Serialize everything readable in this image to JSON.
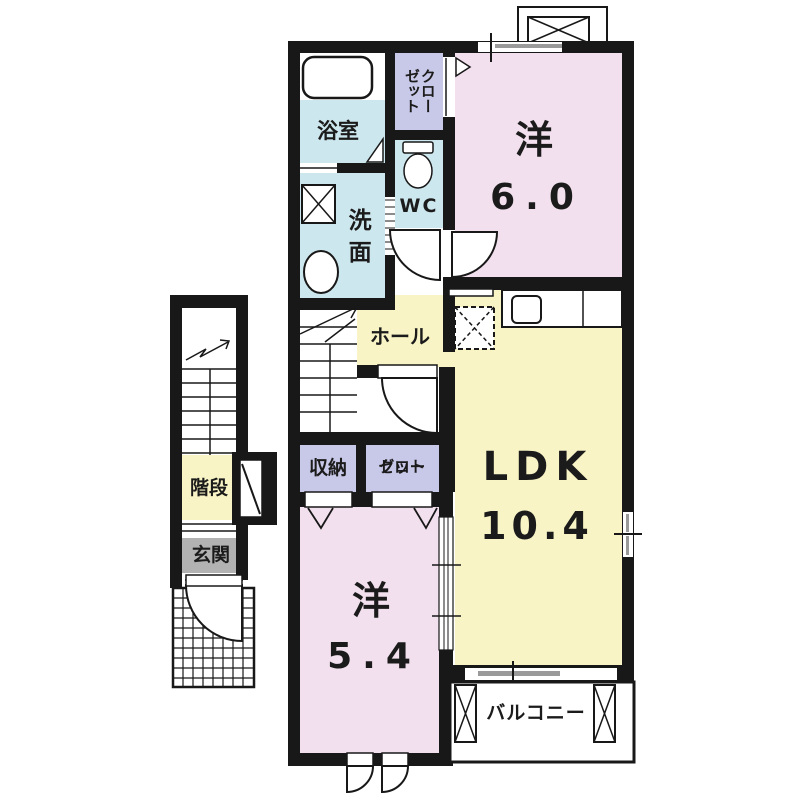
{
  "document": {
    "type": "apartment-floor-plan"
  },
  "colors": {
    "wall": "#181818",
    "room_pink": "#f3e0ee",
    "room_yellow": "#f8f4c5",
    "wet_blue": "#cde7ee",
    "closet_lavender": "#c8c8e8",
    "entrance_gray": "#b2b2b2",
    "window_gray": "#9a9a9a",
    "text": "#1b1b1b"
  },
  "rooms": {
    "bath": {
      "label": "浴室"
    },
    "washroom": {
      "label": "洗面"
    },
    "wc": {
      "label": "WC"
    },
    "closet_upper": {
      "line1": "クロー",
      "line2": "ゼット"
    },
    "bedroom_east": {
      "label": "洋",
      "size": "6.0"
    },
    "hall": {
      "label": "ホール"
    },
    "ldk": {
      "label": "LDK",
      "size": "10.4"
    },
    "storage": {
      "label": "収納"
    },
    "closet_lower": {
      "line1": "クロー",
      "line2": "ゼット"
    },
    "bedroom_south": {
      "label": "洋",
      "size": "5.4"
    },
    "balcony": {
      "label": "バルコニー"
    },
    "staircase": {
      "label": "階段"
    },
    "entrance": {
      "label": "玄関"
    }
  }
}
